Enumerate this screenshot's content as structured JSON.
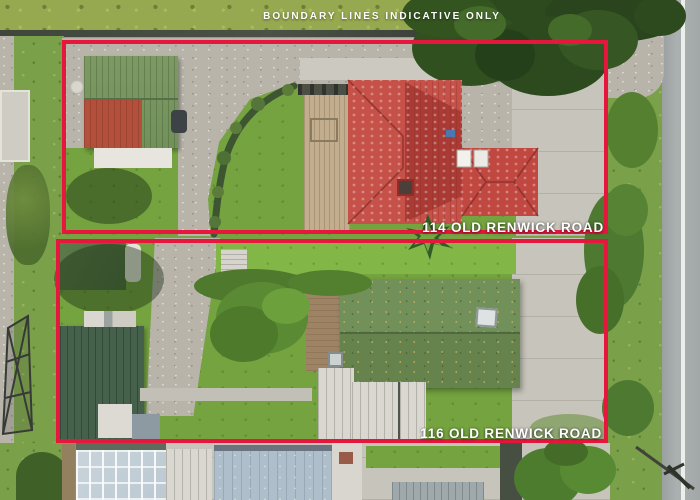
{
  "overlay": {
    "disclaimer": "BOUNDARY LINES INDICATIVE ONLY",
    "parcels": [
      {
        "id": "114",
        "label": "114 OLD RENWICK ROAD"
      },
      {
        "id": "116",
        "label": "116 OLD RENWICK ROAD"
      }
    ]
  },
  "palette": {
    "boundary": "#e6173c",
    "label": "#ffffff",
    "grass": "#7ba04a",
    "gravel": "#b8b4aa",
    "concrete": "#c7c4bb",
    "roof-red": "#c65149",
    "roof-moss-green": "#6e8c54",
    "roof-dark-green": "#45614b",
    "tree-dark": "#2d4a1f",
    "road": "#a6abab"
  },
  "scene": {
    "type": "aerial-drone-photo",
    "subject": "two residential properties with red indicative boundary outlines beside a road"
  }
}
